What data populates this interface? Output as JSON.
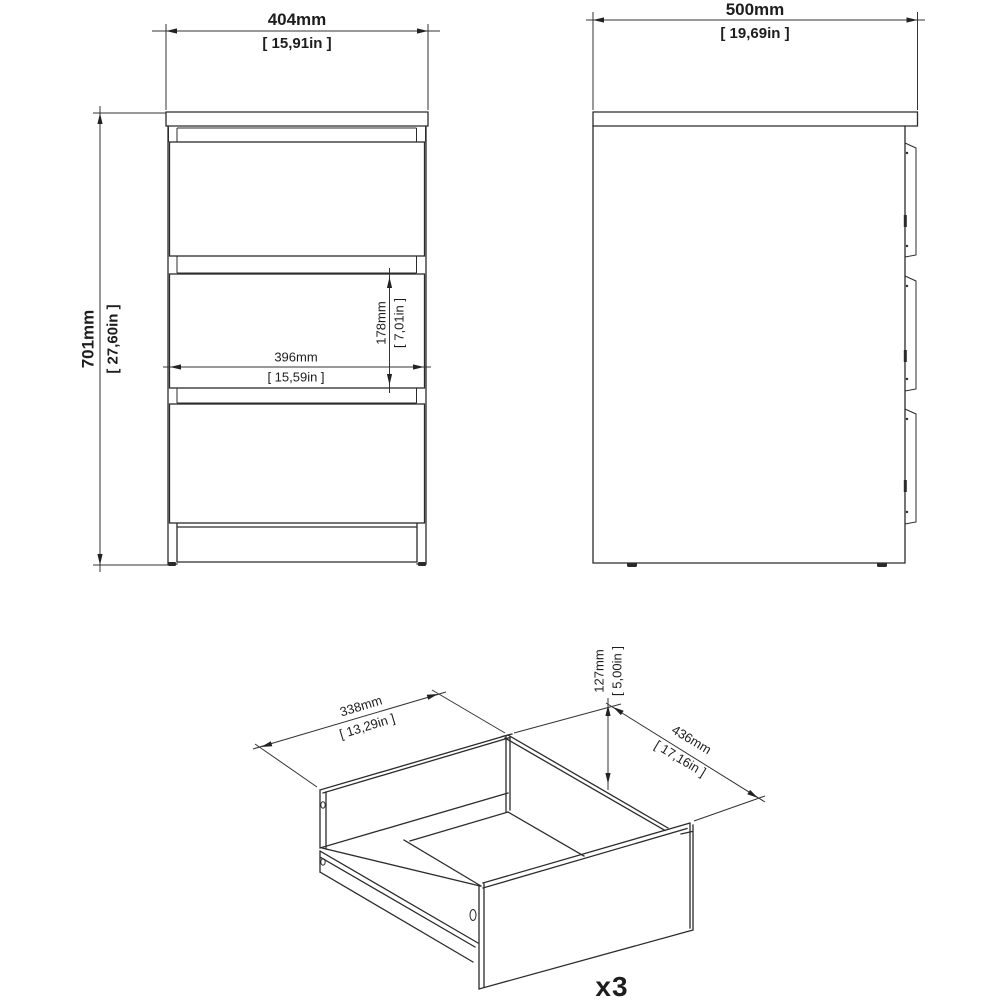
{
  "drawing": {
    "type": "furniture-technical-drawing",
    "views": [
      "front-view",
      "side-view",
      "drawer-isometric-view"
    ]
  },
  "dims": {
    "front_width": {
      "mm": "404mm",
      "in": "[ 15,91in ]"
    },
    "front_height": {
      "mm": "701mm",
      "in": "[ 27,60in ]"
    },
    "inner_width": {
      "mm": "396mm",
      "in": "[ 15,59in ]"
    },
    "drawer_front_height": {
      "mm": "178mm",
      "in": "[ 7,01in ]"
    },
    "side_depth": {
      "mm": "500mm",
      "in": "[ 19,69in ]"
    },
    "drawer_box_width": {
      "mm": "338mm",
      "in": "[ 13,29in ]"
    },
    "drawer_box_height": {
      "mm": "127mm",
      "in": "[ 5,00in ]"
    },
    "drawer_box_depth": {
      "mm": "436mm",
      "in": "[ 17,16in ]"
    }
  },
  "drawer_quantity_label": "x3",
  "colors": {
    "line": "#2b2b2b",
    "dimension_line": "#333333",
    "background": "#ffffff"
  }
}
